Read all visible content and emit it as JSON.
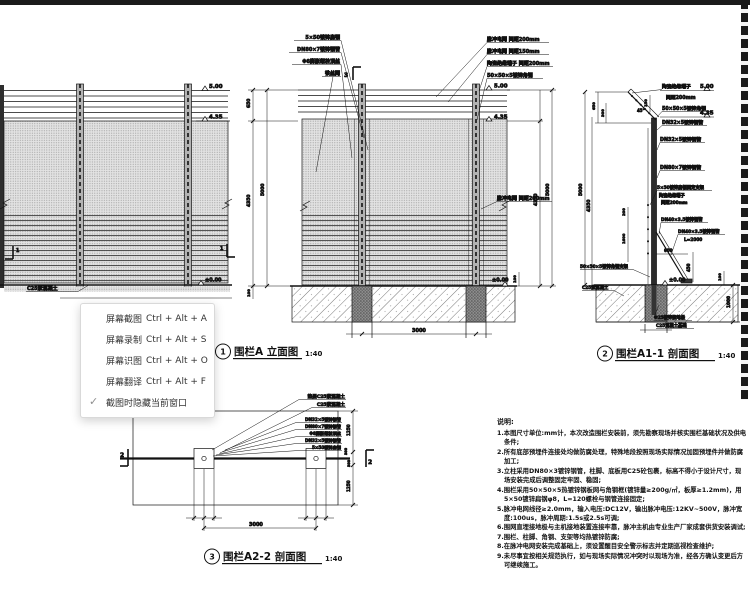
{
  "menu": {
    "items": [
      {
        "label": "屏幕截图",
        "shortcut": "Ctrl + Alt + A"
      },
      {
        "label": "屏幕录制",
        "shortcut": "Ctrl + Alt + S"
      },
      {
        "label": "屏幕识图",
        "shortcut": "Ctrl + Alt + O"
      },
      {
        "label": "屏幕翻译",
        "shortcut": "Ctrl + Alt + F"
      }
    ],
    "toggle": {
      "label": "截图时隐藏当前窗口",
      "check_glyph": "✓",
      "checked": true
    }
  },
  "ghost_text": "围栏A 立面图",
  "titles": {
    "t1": {
      "no": "1",
      "name": "围栏A 立面图",
      "scale": "1:40"
    },
    "t2": {
      "no": "2",
      "name": "围栏A1-1 剖面图",
      "scale": "1:40"
    },
    "t3": {
      "no": "3",
      "name": "围栏A2-2 剖面图",
      "scale": "1:40"
    }
  },
  "d1": {
    "levels": {
      "top": "5.00",
      "mid": "4.35",
      "base": "±0.00"
    },
    "material": "C25素混凝土",
    "section_marker": "1"
  },
  "d2": {
    "callouts_left": [
      "5×50镀锌扁钢",
      "DN80×7镀锌钢管",
      "Φ8膨胀螺栓顶丝",
      "铁丝网"
    ],
    "callouts_right": [
      "脉冲电网 间距200mm",
      "脉冲电网 间距150mm",
      "陶瓷绝缘端子 间距200mm",
      "50×50×5镀锌角钢"
    ],
    "callout_mid": "脉冲电网 间距200mm",
    "levels": {
      "top": "5.00",
      "mid": "4.35",
      "base": "±0.00"
    },
    "dims": {
      "left_top": "650",
      "left_main": "4350",
      "left_total": "5000",
      "left_base": "100",
      "right_main": "4350",
      "right_total": "5000",
      "curb": "100",
      "span": "3000"
    },
    "section_marker": "3"
  },
  "d3": {
    "callouts": {
      "insulator": "陶瓷绝缘端子",
      "insulator_gap": "间距200mm",
      "angle_steel": "50×50×5镀锌角钢",
      "pipe1": "DN32×5镀锌钢管",
      "pipe2": "DN32×5镀锌钢管",
      "pipe3": "DN80×7镀锌钢管",
      "flat_bracket": "5×50镀锌扁钢固定支架",
      "insulator2": "陶瓷绝缘端子",
      "insulator2_gap": "间距200mm"
    },
    "brace": {
      "l1": "DN40×3.5镀锌钢管",
      "l2": "DN40×3.5镀锌钢管",
      "l3": "L=2000"
    },
    "left_labels": {
      "bracket": "50×50×5镀锌角钢支架",
      "concrete": "C25素混凝土"
    },
    "bottom_labels": {
      "earth": "Φ25镀锌接地极",
      "foundation": "C25混凝土基础"
    },
    "levels": {
      "top": "5.00",
      "mid": "4.35",
      "base": "±0.00"
    },
    "dims": {
      "arm": "650",
      "arm2": "300",
      "arm3": "150",
      "angle": "45°",
      "total": "5000",
      "main": "4350",
      "mid1": "200",
      "mid2": "1600",
      "brace_h": "600",
      "brace_v": "450",
      "depth": "1000",
      "curb": "100"
    }
  },
  "d4": {
    "callouts_top": [
      "垫层C25素混凝土",
      "C25素混凝土"
    ],
    "callouts": [
      "DN32×5镀锌钢管",
      "DN80×7镀锌钢管",
      "Φ8膨胀螺栓顶丝",
      "DN32×5镀锌钢管",
      "5×50镀锌扁钢"
    ],
    "dims": {
      "side_top": "1250",
      "side_mid1": "300",
      "side_mid2": "300",
      "side_bot": "1250",
      "span": "3000"
    },
    "marker": "2"
  },
  "notes": {
    "heading": "说明:",
    "lines": [
      "1.本图尺寸单位:mm计，本次改造围栏安装前，须先勘察现场并核实围栏基础状况及供电条件;",
      "2.所有底部预埋件连接处均做防腐处理，特殊地段按照现场实际情况加固预埋件并做防腐加工;",
      "3.立柱采用DN80×3镀锌钢管，柱脚、底板用C25砼包裹，标高不得小于设计尺寸，现场安装完成后调整固定牢固、稳固;",
      "4.围栏采用50×50×5热镀锌钢板网与角钢框(镀锌量≥200g/㎡，板厚≥1.2mm)，用5×50镀锌扁钢φ8，L=120螺栓与钢管连接固定;",
      "5.脉冲电网线径≥2.0mm，输入电压:DC12V，输出脉冲电压:12KV~500V，脉冲宽度:100us，脉冲周期:1.5s或2.5s可调;",
      "6.围网直埋接地极与主机接地装置连接牢靠，脉冲主机由专业生产厂家成套供货安装调试;",
      "7.围栏、柱脚、角钢、支架等均热镀锌防腐;",
      "8.在脉冲电网安装完成基础上，须设置醒目安全警示标志并定期巡视检查维护;",
      "9.未尽事宜按相关规范执行，如与现场实际情况冲突时以现场为准，经各方确认变更后方可继续施工。"
    ]
  }
}
